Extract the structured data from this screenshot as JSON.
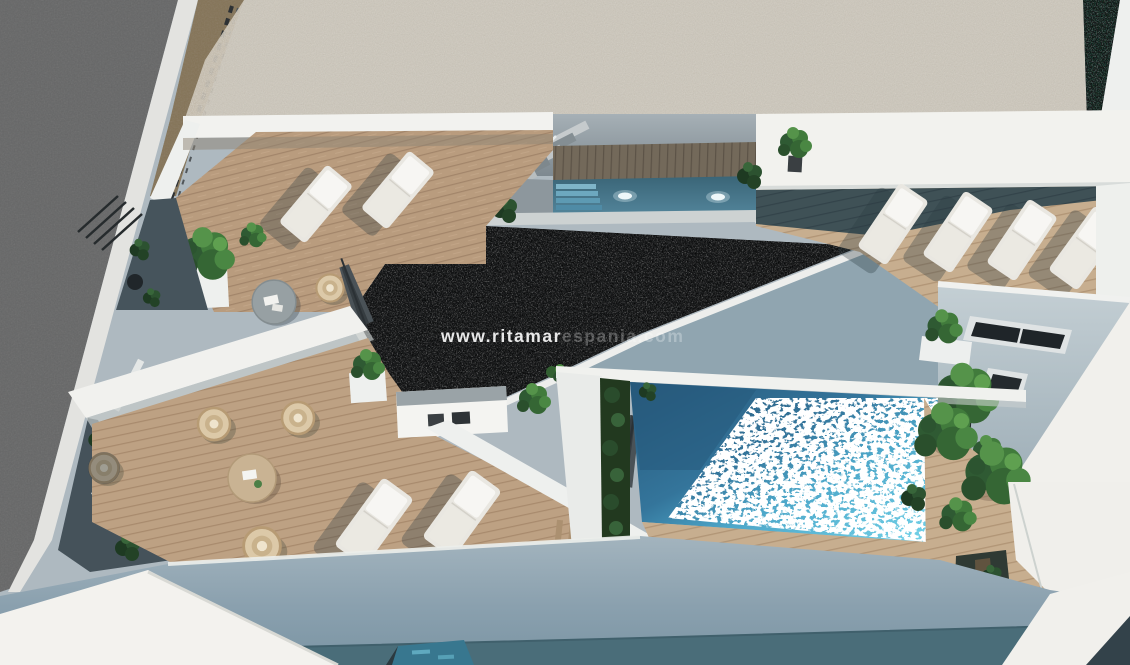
{
  "scene": {
    "type": "aerial-architectural-3d-render",
    "description": "Bird's-eye 3D visualisation of a modern white residential building: rooftop solarium with light and dark gravel roof sections, two swimming pools, timber sun decks, white sun loungers, furnished terraces with rattan chairs and planters, and a grey street at the top left.",
    "watermark": {
      "bold_part": "www.ritamar",
      "faint_part": "espania.com",
      "full_text": "www.ritamarespania.com",
      "color": "#ffffff"
    },
    "counts": {
      "swimming_pools": 2,
      "sun_loungers": 8,
      "terrace_levels": 3,
      "windows_visible": 2,
      "round_tables": 2,
      "rattan_chairs": 4
    },
    "palette": {
      "street": "#6e6e6e",
      "curb": "#e3e3e0",
      "gravel_roof_light": "#d5cec1",
      "gravel_roof_dark": "#3d3d3d",
      "deck_wood_sunlit": "#b99c7e",
      "deck_wood_shaded": "#3f5156",
      "pool_water_shaded": "#2b5f82",
      "pool_water_sunlit": "#63c8e2",
      "walls_sunlit": "#f2f2ee",
      "walls_shaded": "#8ba0ac",
      "facade": "#879dab",
      "facade_base_strip": "#4a6d79",
      "foliage": "#3a6b38"
    }
  }
}
